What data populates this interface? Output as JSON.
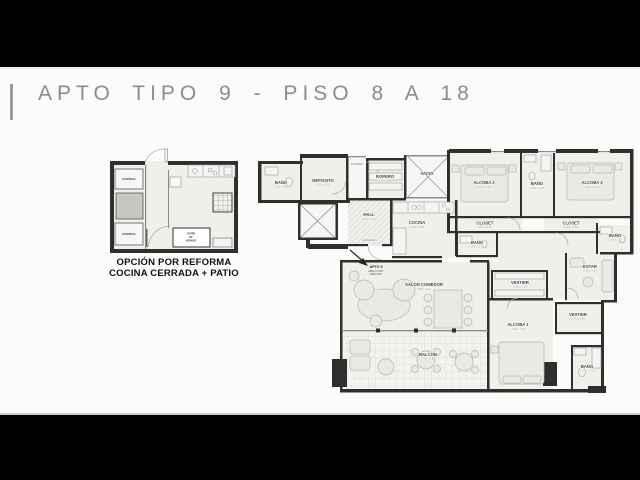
{
  "window": {
    "title": "APTO TIPO 9 - PISO 8 A 18"
  },
  "reform_plan": {
    "caption_line1": "OPCIÓN POR REFORMA",
    "caption_line2": "COCINA CERRADA + PATIO",
    "labels": {
      "despensa_top": "DESPENSA",
      "despensa_bottom": "DESPENSA",
      "torre_line1": "TORRE",
      "torre_line2": "DE",
      "torre_line3": "HORNOS"
    }
  },
  "floor_plan": {
    "apto": {
      "name": "APTO 9",
      "info_line1": "AREA CONST.",
      "info_line2": "AREA PRIV."
    },
    "rooms": [
      {
        "label": "BAÑO",
        "dims": "1.50 x 1.90"
      },
      {
        "label": "DEPOSITO",
        "dims": "1.60 x 2.20"
      },
      {
        "label": "ACCESO",
        "dims": ""
      },
      {
        "label": "ROPERO",
        "dims": "1.30 x 1.90"
      },
      {
        "label": "VACIO",
        "dims": ""
      },
      {
        "label": "ALCOBA 2",
        "dims": "3.20 x 3.15"
      },
      {
        "label": "BAÑO",
        "dims": "1.55 x 3.00"
      },
      {
        "label": "ALCOBA 3",
        "dims": "3.30 x 3.15"
      },
      {
        "label": "CLOSET",
        "dims": "3.20 x 0.60"
      },
      {
        "label": "BAÑO",
        "dims": "1.80 x 1.10"
      },
      {
        "label": "CLOSET",
        "dims": "2.40 x 0.60"
      },
      {
        "label": "BAÑO",
        "dims": "1.50 x 1.20"
      },
      {
        "label": "HALL",
        "dims": "1.90 x 2.10"
      },
      {
        "label": "ACCESO",
        "dims": ""
      },
      {
        "label": "COCINA",
        "dims": "2.60 x 2.90"
      },
      {
        "label": "SALON COMEDOR",
        "dims": "7.05 x 3.20"
      },
      {
        "label": "VESTIER",
        "dims": "2.60 x 1.20"
      },
      {
        "label": "ESTAR",
        "dims": "2.30 x 2.10"
      },
      {
        "label": "ALCOBA 1",
        "dims": "3.10 x 4.10"
      },
      {
        "label": "VESTIER",
        "dims": "2.00 x 1.40"
      },
      {
        "label": "BAÑO",
        "dims": "1.40 x 2.10"
      },
      {
        "label": "BALCON",
        "dims": "7.40 x 2.80"
      }
    ]
  }
}
